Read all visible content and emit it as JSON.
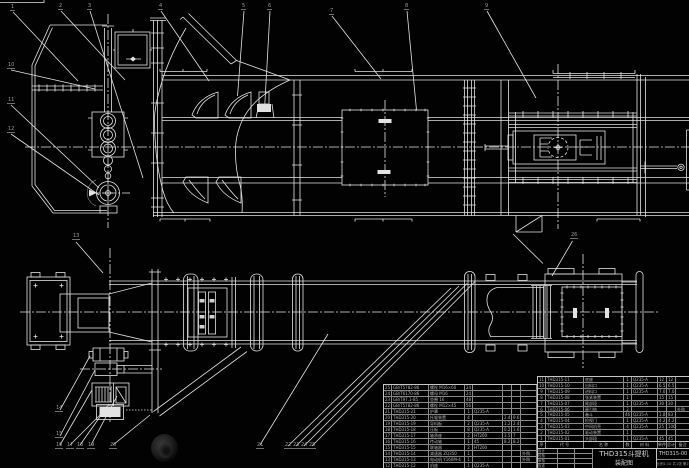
{
  "title_block": {
    "product": "THD315斗提机",
    "doc": "装配图",
    "code": "THD315-00",
    "sub": "比例1:10 共1张 第1张",
    "sign_rows": [
      [
        "设计",
        "",
        ""
      ],
      [
        "校核",
        "",
        ""
      ],
      [
        "审核",
        "",
        ""
      ],
      [
        "批准",
        "",
        ""
      ]
    ]
  },
  "bom": {
    "header": [
      "序",
      "代 号",
      "名 称",
      "数",
      "材 料",
      "单件",
      "总计",
      "备注"
    ],
    "left_rows": [
      [
        "25",
        "GB/T5782-86",
        "螺栓 M16×60",
        "24",
        "",
        "",
        "",
        ""
      ],
      [
        "24",
        "GB/T6170-86",
        "螺母 M16",
        "24",
        "",
        "",
        "",
        ""
      ],
      [
        "23",
        "GB/T97.1-85",
        "垫圈 16",
        "48",
        "",
        "",
        "",
        ""
      ],
      [
        "22",
        "GB/T5782-86",
        "螺栓 M12×45",
        "56",
        "",
        "",
        "",
        ""
      ],
      [
        "21",
        "THD315-21",
        "护罩",
        "1",
        "Q235-A",
        "",
        "",
        ""
      ],
      [
        "20",
        "THD315-20",
        "托辊装置",
        "4",
        "",
        "2.4",
        "9.6",
        ""
      ],
      [
        "19",
        "THD315-19",
        "导料板",
        "2",
        "Q235-A",
        "1.2",
        "2.4",
        ""
      ],
      [
        "18",
        "THD315-18",
        "压板",
        "8",
        "Q235-A",
        "0.2",
        "1.6",
        ""
      ],
      [
        "17",
        "THD315-17",
        "轴承座",
        "2",
        "HT200",
        "3.5",
        "7",
        ""
      ],
      [
        "16",
        "THD315-16",
        "传动轴",
        "1",
        "45",
        "8.2",
        "8.2",
        ""
      ],
      [
        "15",
        "THD315-15",
        "联轴器",
        "2",
        "HT200",
        "",
        "",
        ""
      ],
      [
        "14",
        "THD315-14",
        "减速器 ZQ350",
        "1",
        "",
        "",
        "",
        "外购"
      ],
      [
        "13",
        "THD315-13",
        "电动机 Y160M-4",
        "1",
        "",
        "",
        "",
        "外购"
      ],
      [
        "12",
        "THD315-12",
        "机座",
        "1",
        "Q235-A",
        "",
        "",
        ""
      ]
    ],
    "right_rows": [
      [
        "11",
        "THD315-11",
        "底座",
        "1",
        "Q235-A",
        "12",
        "12",
        ""
      ],
      [
        "10",
        "THD315-10",
        "出料口",
        "1",
        "Q235-A",
        "6.5",
        "6.5",
        ""
      ],
      [
        "9",
        "THD315-09",
        "进料口",
        "1",
        "Q235-A",
        "7.0",
        "7.0",
        ""
      ],
      [
        "8",
        "THD315-08",
        "张紧装置",
        "1",
        "",
        "15",
        "15",
        ""
      ],
      [
        "7",
        "THD315-07",
        "尾部段",
        "1",
        "Q235-A",
        "30",
        "30",
        ""
      ],
      [
        "6",
        "THD315-06",
        "牵引链",
        "2",
        "",
        "",
        "",
        "外购"
      ],
      [
        "5",
        "THD315-05",
        "畚斗",
        "46",
        "Q235-A",
        "1.8",
        "83",
        ""
      ],
      [
        "4",
        "THD315-04",
        "检视门",
        "1",
        "Q235-A",
        "4.2",
        "4.2",
        ""
      ],
      [
        "3",
        "THD315-03",
        "中间机壳",
        "4",
        "Q235-A",
        "25",
        "100",
        ""
      ],
      [
        "2",
        "THD315-02",
        "驱动装置",
        "1",
        "",
        "",
        "",
        ""
      ],
      [
        "1",
        "THD315-01",
        "头部段",
        "1",
        "Q235-A",
        "45",
        "45",
        ""
      ]
    ]
  },
  "leader_labels": [
    {
      "x": 10,
      "y": 5,
      "t": "1"
    },
    {
      "x": 58,
      "y": 4,
      "t": "2"
    },
    {
      "x": 87,
      "y": 4,
      "t": "3"
    },
    {
      "x": 158,
      "y": 4,
      "t": "4"
    },
    {
      "x": 241,
      "y": 4,
      "t": "5"
    },
    {
      "x": 267,
      "y": 4,
      "t": "6"
    },
    {
      "x": 329,
      "y": 9,
      "t": "7"
    },
    {
      "x": 404,
      "y": 4,
      "t": "8"
    },
    {
      "x": 484,
      "y": 4,
      "t": "9"
    },
    {
      "x": 7,
      "y": 63,
      "t": "10"
    },
    {
      "x": 7,
      "y": 98,
      "t": "11"
    },
    {
      "x": 7,
      "y": 127,
      "t": "12"
    },
    {
      "x": 72,
      "y": 234,
      "t": "13"
    },
    {
      "x": 55,
      "y": 406,
      "t": "14"
    },
    {
      "x": 55,
      "y": 432,
      "t": "15"
    },
    {
      "x": 55,
      "y": 443,
      "t": "16"
    },
    {
      "x": 66,
      "y": 443,
      "t": "17"
    },
    {
      "x": 76,
      "y": 443,
      "t": "18"
    },
    {
      "x": 87,
      "y": 443,
      "t": "19"
    },
    {
      "x": 109,
      "y": 443,
      "t": "20"
    },
    {
      "x": 256,
      "y": 443,
      "t": "21"
    },
    {
      "x": 284,
      "y": 443,
      "t": "22"
    },
    {
      "x": 292,
      "y": 443,
      "t": "23"
    },
    {
      "x": 300,
      "y": 443,
      "t": "24"
    },
    {
      "x": 308,
      "y": 443,
      "t": "25"
    },
    {
      "x": 570,
      "y": 233,
      "t": "26"
    }
  ],
  "layout": {
    "left_cols": [
      8,
      37,
      36,
      8,
      30,
      9,
      9,
      16
    ],
    "right_cols": [
      8,
      38,
      40,
      8,
      26,
      9,
      9,
      14
    ]
  }
}
